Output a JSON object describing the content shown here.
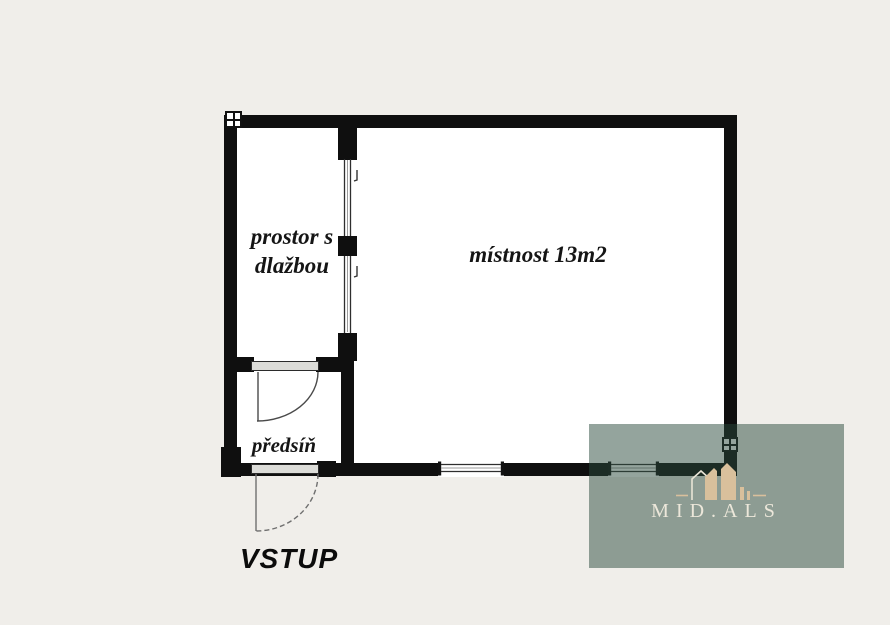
{
  "colors": {
    "page_background": "#f0eeea",
    "wall": "#0f0f0f",
    "room_fill": "#ffffff",
    "threshold_fill": "#dcdcd8",
    "door_arc": "#4a4a4a",
    "watermark_overlay": "rgba(42,73,59,0.5)",
    "logo_beige": "#d9c09c",
    "watermark_text": "#ece7da"
  },
  "floorplan": {
    "rooms": [
      {
        "id": "tiled-space",
        "label_lines": [
          "prostor s",
          "dlažbou"
        ]
      },
      {
        "id": "main-room",
        "label_lines": [
          "místnost 13m2"
        ]
      },
      {
        "id": "vestibule",
        "label_lines": [
          "předsíň"
        ]
      }
    ],
    "entrance_label": "VSTUP"
  },
  "watermark": {
    "brand": "MID.ALS",
    "logo_icon": "house-logo-icon"
  }
}
